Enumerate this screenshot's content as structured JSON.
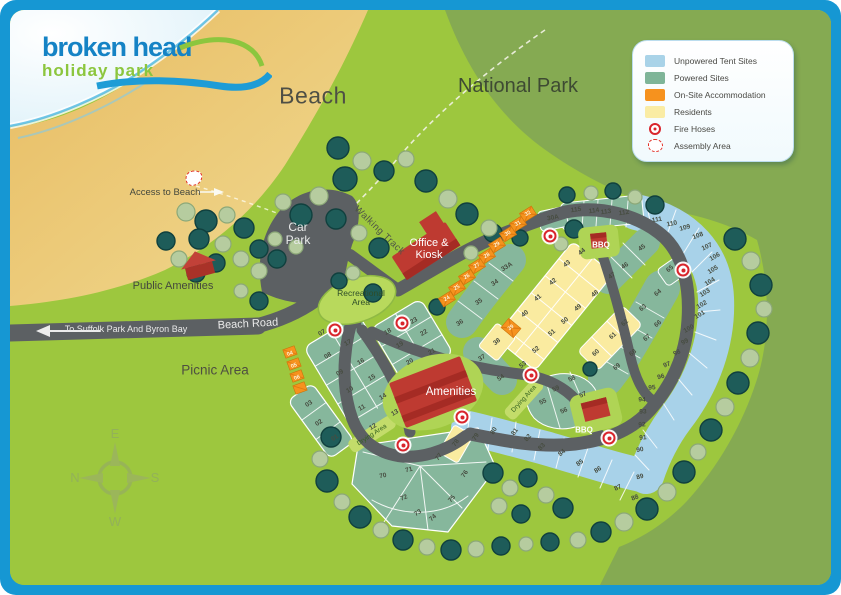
{
  "logo": {
    "name": "broken head",
    "tagline": "holiday park"
  },
  "labels": {
    "beach": "Beach",
    "national_park": "National Park",
    "access_to_beach": "Access to Beach",
    "car_park": "Car Park",
    "public_amenities": "Public Amenities",
    "office_kiosk": "Office & Kiosk",
    "recreational_area": "Recreational Area",
    "beach_road": "Beach Road",
    "to_suffolk": "To Suffolk Park And Byron Bay",
    "picnic_area": "Picnic Area",
    "amenities": "Amenities",
    "bbq": "BBQ",
    "drying_area": "Drying Area",
    "walking_track": "Walking Track",
    "compass": {
      "top": "E",
      "left": "N",
      "right": "S",
      "bottom": "W"
    }
  },
  "legend": {
    "items": [
      {
        "label": "Unpowered Tent Sites",
        "swatch": "color",
        "color": "#A9D3E8"
      },
      {
        "label": "Powered Sites",
        "swatch": "color",
        "color": "#7FB598"
      },
      {
        "label": "On-Site Accommodation",
        "swatch": "color",
        "color": "#F6921E"
      },
      {
        "label": "Residents",
        "swatch": "color",
        "color": "#FAECA4"
      },
      {
        "label": "Fire Hoses",
        "swatch": "fire"
      },
      {
        "label": "Assembly Area",
        "swatch": "assembly"
      }
    ]
  },
  "map": {
    "site_colors": {
      "powered": "#86B79C",
      "unpowered": "#A8D2E9",
      "residents": "#FAEBA0",
      "accommodation": "#F6921E"
    },
    "sites": [
      {
        "n": "01",
        "x": 335,
        "y": 438,
        "r": -35,
        "t": "p"
      },
      {
        "n": "02",
        "x": 319,
        "y": 423,
        "r": -35,
        "t": "p"
      },
      {
        "n": "03",
        "x": 309,
        "y": 404,
        "r": -35,
        "t": "p"
      },
      {
        "n": "04",
        "x": 290,
        "y": 354,
        "r": -20,
        "t": "a"
      },
      {
        "n": "05",
        "x": 294,
        "y": 366,
        "r": -20,
        "t": "a"
      },
      {
        "n": "06",
        "x": 297,
        "y": 378,
        "r": -20,
        "t": "a"
      },
      {
        "n": "07",
        "x": 322,
        "y": 333,
        "r": -30,
        "t": "p"
      },
      {
        "n": "08",
        "x": 328,
        "y": 356,
        "r": -30,
        "t": "p"
      },
      {
        "n": "09",
        "x": 340,
        "y": 373,
        "r": -30,
        "t": "p"
      },
      {
        "n": "10",
        "x": 350,
        "y": 390,
        "r": -30,
        "t": "p"
      },
      {
        "n": "11",
        "x": 362,
        "y": 408,
        "r": -30,
        "t": "p"
      },
      {
        "n": "12",
        "x": 373,
        "y": 427,
        "r": -30,
        "t": "p"
      },
      {
        "n": "13",
        "x": 395,
        "y": 413,
        "r": -30,
        "t": "p"
      },
      {
        "n": "14",
        "x": 383,
        "y": 397,
        "r": -30,
        "t": "p"
      },
      {
        "n": "15",
        "x": 372,
        "y": 378,
        "r": -30,
        "t": "p"
      },
      {
        "n": "16",
        "x": 361,
        "y": 362,
        "r": -30,
        "t": "p"
      },
      {
        "n": "17",
        "x": 348,
        "y": 343,
        "r": -30,
        "t": "p"
      },
      {
        "n": "18",
        "x": 388,
        "y": 332,
        "r": -30,
        "t": "p"
      },
      {
        "n": "19",
        "x": 400,
        "y": 345,
        "r": -30,
        "t": "p"
      },
      {
        "n": "20",
        "x": 410,
        "y": 362,
        "r": -30,
        "t": "p"
      },
      {
        "n": "21",
        "x": 432,
        "y": 352,
        "r": -30,
        "t": "p"
      },
      {
        "n": "22",
        "x": 424,
        "y": 333,
        "r": -30,
        "t": "p"
      },
      {
        "n": "23",
        "x": 414,
        "y": 321,
        "r": -30,
        "t": "p"
      },
      {
        "n": "24",
        "x": 447,
        "y": 299,
        "r": -30,
        "t": "a"
      },
      {
        "n": "25",
        "x": 457,
        "y": 288,
        "r": -30,
        "t": "a"
      },
      {
        "n": "26",
        "x": 467,
        "y": 277,
        "r": -30,
        "t": "a"
      },
      {
        "n": "27",
        "x": 477,
        "y": 266,
        "r": -30,
        "t": "a"
      },
      {
        "n": "28",
        "x": 487,
        "y": 256,
        "r": -30,
        "t": "a"
      },
      {
        "n": "29",
        "x": 497,
        "y": 245,
        "r": -30,
        "t": "a"
      },
      {
        "n": "30",
        "x": 508,
        "y": 234,
        "r": -30,
        "t": "a"
      },
      {
        "n": "31",
        "x": 518,
        "y": 224,
        "r": -30,
        "t": "a"
      },
      {
        "n": "32",
        "x": 528,
        "y": 214,
        "r": -30,
        "t": "a"
      },
      {
        "n": "30A",
        "x": 553,
        "y": 218,
        "r": -10,
        "t": "p"
      },
      {
        "n": "33A",
        "x": 507,
        "y": 267,
        "r": -32,
        "t": "p"
      },
      {
        "n": "34",
        "x": 495,
        "y": 283,
        "r": -32,
        "t": "p"
      },
      {
        "n": "35",
        "x": 479,
        "y": 302,
        "r": -32,
        "t": "p"
      },
      {
        "n": "36",
        "x": 460,
        "y": 323,
        "r": -32,
        "t": "p"
      },
      {
        "n": "37",
        "x": 482,
        "y": 358,
        "r": -32,
        "t": "p"
      },
      {
        "n": "38",
        "x": 497,
        "y": 342,
        "r": -38,
        "t": "r"
      },
      {
        "n": "39",
        "x": 511,
        "y": 328,
        "r": -38,
        "t": "a"
      },
      {
        "n": "40",
        "x": 525,
        "y": 314,
        "r": -38,
        "t": "r"
      },
      {
        "n": "41",
        "x": 538,
        "y": 298,
        "r": -38,
        "t": "r"
      },
      {
        "n": "42",
        "x": 553,
        "y": 282,
        "r": -38,
        "t": "r"
      },
      {
        "n": "43",
        "x": 567,
        "y": 264,
        "r": -38,
        "t": "r"
      },
      {
        "n": "44",
        "x": 582,
        "y": 252,
        "r": -38,
        "t": "r"
      },
      {
        "n": "45",
        "x": 642,
        "y": 248,
        "r": -35,
        "t": "p"
      },
      {
        "n": "46",
        "x": 625,
        "y": 266,
        "r": -35,
        "t": "p"
      },
      {
        "n": "47",
        "x": 612,
        "y": 276,
        "r": -35,
        "t": "p"
      },
      {
        "n": "48",
        "x": 595,
        "y": 294,
        "r": -38,
        "t": "r"
      },
      {
        "n": "49",
        "x": 578,
        "y": 308,
        "r": -38,
        "t": "r"
      },
      {
        "n": "50",
        "x": 565,
        "y": 321,
        "r": -38,
        "t": "r"
      },
      {
        "n": "51",
        "x": 552,
        "y": 333,
        "r": -38,
        "t": "r"
      },
      {
        "n": "52",
        "x": 536,
        "y": 350,
        "r": -38,
        "t": "r"
      },
      {
        "n": "53",
        "x": 523,
        "y": 365,
        "r": -38,
        "t": "r"
      },
      {
        "n": "54",
        "x": 501,
        "y": 378,
        "r": -35,
        "t": "p"
      },
      {
        "n": "55",
        "x": 543,
        "y": 402,
        "r": -25,
        "t": "p"
      },
      {
        "n": "56",
        "x": 564,
        "y": 411,
        "r": -25,
        "t": "p"
      },
      {
        "n": "57",
        "x": 583,
        "y": 395,
        "r": -25,
        "t": "p"
      },
      {
        "n": "58",
        "x": 572,
        "y": 379,
        "r": -25,
        "t": "p"
      },
      {
        "n": "59",
        "x": 556,
        "y": 389,
        "r": -25,
        "t": "p"
      },
      {
        "n": "60",
        "x": 596,
        "y": 353,
        "r": -42,
        "t": "r"
      },
      {
        "n": "61",
        "x": 613,
        "y": 336,
        "r": -42,
        "t": "r"
      },
      {
        "n": "62",
        "x": 625,
        "y": 323,
        "r": -42,
        "t": "r"
      },
      {
        "n": "63",
        "x": 643,
        "y": 308,
        "r": -40,
        "t": "p"
      },
      {
        "n": "64",
        "x": 658,
        "y": 293,
        "r": -40,
        "t": "p"
      },
      {
        "n": "65",
        "x": 670,
        "y": 269,
        "r": -40,
        "t": "p"
      },
      {
        "n": "66",
        "x": 658,
        "y": 324,
        "r": -40,
        "t": "p"
      },
      {
        "n": "67",
        "x": 647,
        "y": 338,
        "r": -40,
        "t": "p"
      },
      {
        "n": "68",
        "x": 633,
        "y": 353,
        "r": -40,
        "t": "p"
      },
      {
        "n": "69",
        "x": 617,
        "y": 367,
        "r": -40,
        "t": "p"
      },
      {
        "n": "70",
        "x": 383,
        "y": 476,
        "r": -12,
        "t": "p"
      },
      {
        "n": "71",
        "x": 409,
        "y": 470,
        "r": -15,
        "t": "p"
      },
      {
        "n": "72",
        "x": 404,
        "y": 498,
        "r": -22,
        "t": "p"
      },
      {
        "n": "73",
        "x": 418,
        "y": 513,
        "r": -32,
        "t": "p"
      },
      {
        "n": "74",
        "x": 433,
        "y": 518,
        "r": -42,
        "t": "p"
      },
      {
        "n": "75",
        "x": 452,
        "y": 499,
        "r": -48,
        "t": "p"
      },
      {
        "n": "76",
        "x": 465,
        "y": 474,
        "r": -55,
        "t": "p"
      },
      {
        "n": "77",
        "x": 439,
        "y": 457,
        "r": -55,
        "t": "p"
      },
      {
        "n": "78",
        "x": 456,
        "y": 443,
        "r": -55,
        "t": "r"
      },
      {
        "n": "79",
        "x": 476,
        "y": 437,
        "r": -58,
        "t": "u"
      },
      {
        "n": "80",
        "x": 494,
        "y": 431,
        "r": -58,
        "t": "u"
      },
      {
        "n": "81",
        "x": 515,
        "y": 432,
        "r": -52,
        "t": "u"
      },
      {
        "n": "82",
        "x": 528,
        "y": 438,
        "r": -48,
        "t": "u"
      },
      {
        "n": "83",
        "x": 542,
        "y": 447,
        "r": -45,
        "t": "u"
      },
      {
        "n": "84",
        "x": 562,
        "y": 453,
        "r": -40,
        "t": "u"
      },
      {
        "n": "85",
        "x": 580,
        "y": 463,
        "r": -36,
        "t": "u"
      },
      {
        "n": "86",
        "x": 598,
        "y": 470,
        "r": -32,
        "t": "u"
      },
      {
        "n": "87",
        "x": 618,
        "y": 488,
        "r": -26,
        "t": "u"
      },
      {
        "n": "88",
        "x": 635,
        "y": 498,
        "r": -20,
        "t": "u"
      },
      {
        "n": "89",
        "x": 640,
        "y": 477,
        "r": -14,
        "t": "u"
      },
      {
        "n": "90",
        "x": 640,
        "y": 450,
        "r": -10,
        "t": "u"
      },
      {
        "n": "91",
        "x": 643,
        "y": 438,
        "r": -6,
        "t": "u"
      },
      {
        "n": "92",
        "x": 642,
        "y": 425,
        "r": -4,
        "t": "u"
      },
      {
        "n": "93",
        "x": 643,
        "y": 412,
        "r": -2,
        "t": "u"
      },
      {
        "n": "94",
        "x": 642,
        "y": 400,
        "r": 0,
        "t": "u"
      },
      {
        "n": "95",
        "x": 652,
        "y": 388,
        "r": -5,
        "t": "u"
      },
      {
        "n": "96",
        "x": 661,
        "y": 377,
        "r": -15,
        "t": "u"
      },
      {
        "n": "97",
        "x": 667,
        "y": 365,
        "r": -20,
        "t": "u"
      },
      {
        "n": "98",
        "x": 677,
        "y": 353,
        "r": -25,
        "t": "u"
      },
      {
        "n": "99",
        "x": 685,
        "y": 342,
        "r": -28,
        "t": "u"
      },
      {
        "n": "100",
        "x": 689,
        "y": 329,
        "r": -30,
        "t": "u"
      },
      {
        "n": "101",
        "x": 700,
        "y": 315,
        "r": -30,
        "t": "u"
      },
      {
        "n": "102",
        "x": 702,
        "y": 305,
        "r": -30,
        "t": "u"
      },
      {
        "n": "103",
        "x": 705,
        "y": 293,
        "r": -32,
        "t": "u"
      },
      {
        "n": "104",
        "x": 710,
        "y": 282,
        "r": -32,
        "t": "u"
      },
      {
        "n": "105",
        "x": 713,
        "y": 270,
        "r": -32,
        "t": "u"
      },
      {
        "n": "106",
        "x": 715,
        "y": 257,
        "r": -30,
        "t": "u"
      },
      {
        "n": "107",
        "x": 707,
        "y": 247,
        "r": -25,
        "t": "u"
      },
      {
        "n": "108",
        "x": 698,
        "y": 236,
        "r": -20,
        "t": "u"
      },
      {
        "n": "109",
        "x": 685,
        "y": 228,
        "r": -15,
        "t": "u"
      },
      {
        "n": "110",
        "x": 672,
        "y": 224,
        "r": -12,
        "t": "u"
      },
      {
        "n": "111",
        "x": 657,
        "y": 220,
        "r": -10,
        "t": "u"
      },
      {
        "n": "112",
        "x": 624,
        "y": 213,
        "r": -8,
        "t": "p"
      },
      {
        "n": "113",
        "x": 606,
        "y": 212,
        "r": -8,
        "t": "p"
      },
      {
        "n": "114",
        "x": 594,
        "y": 211,
        "r": -8,
        "t": "p"
      },
      {
        "n": "115",
        "x": 576,
        "y": 210,
        "r": -8,
        "t": "p"
      }
    ],
    "fire_hoses": [
      {
        "x": 335,
        "y": 330
      },
      {
        "x": 402,
        "y": 323
      },
      {
        "x": 550,
        "y": 236
      },
      {
        "x": 683,
        "y": 270
      },
      {
        "x": 531,
        "y": 375
      },
      {
        "x": 462,
        "y": 417
      },
      {
        "x": 403,
        "y": 445
      },
      {
        "x": 609,
        "y": 438
      }
    ],
    "assembly_areas": [
      {
        "x": 194,
        "y": 178
      }
    ]
  }
}
